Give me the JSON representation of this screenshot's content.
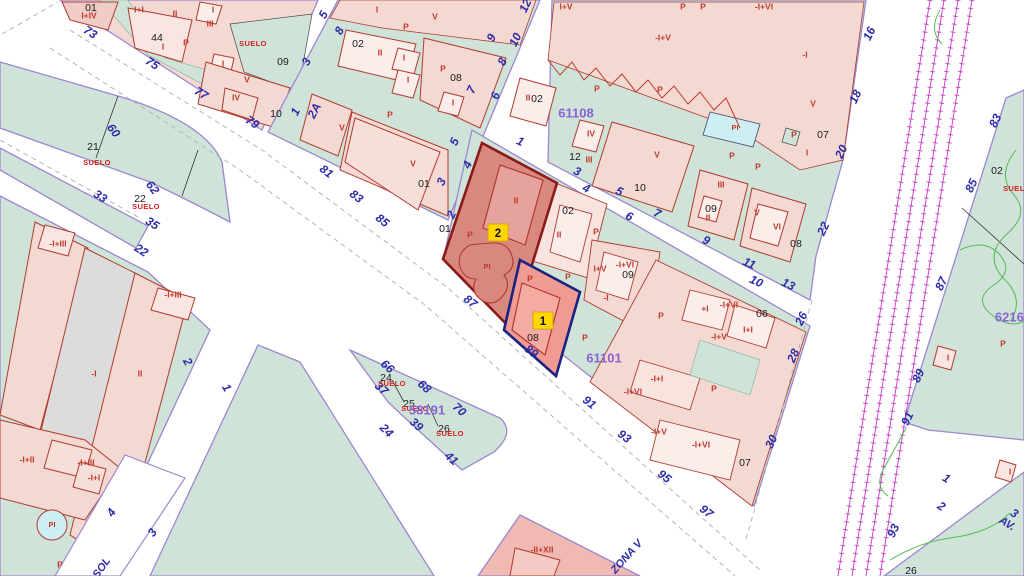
{
  "map": {
    "colors": {
      "street_number": "#2d2da8",
      "parcel_number": "#1a1a1a",
      "floor_label": "#c0392b",
      "suelo_label": "#d42020",
      "block_number": "#8a63d2",
      "badge_fill": "#ffd700",
      "selected_parcel_fill": "#d98880",
      "selected_border_red": "#8b1a1a",
      "selected_border_navy": "#1a237e",
      "green_block": "#cfe3d9",
      "pink_block": "#f4d9d3",
      "pool_fill": "#cdeef2",
      "railway": "#c837c8",
      "boundary_purple": "#9b87d0",
      "contour_green": "#55bb55"
    },
    "suelo_word": "SUELO",
    "selection_badges": [
      {
        "t": "2",
        "x": 498,
        "y": 233
      },
      {
        "t": "1",
        "x": 543,
        "y": 321
      }
    ],
    "block_numbers": [
      {
        "t": "61108",
        "x": 576,
        "y": 114
      },
      {
        "t": "61101",
        "x": 604,
        "y": 359
      },
      {
        "t": "58191",
        "x": 427,
        "y": 411
      },
      {
        "t": "62160",
        "x": 1013,
        "y": 318
      }
    ],
    "street_names": [
      {
        "t": "SOL",
        "x": 102,
        "y": 568,
        "r": -55
      },
      {
        "t": "ZONA V",
        "x": 627,
        "y": 557,
        "r": -48,
        "c": "#4a4a4a"
      },
      {
        "t": "AV.",
        "x": 1007,
        "y": 524,
        "r": 32
      }
    ],
    "street_numbers": [
      {
        "t": "73",
        "x": 90,
        "y": 33,
        "r": 33
      },
      {
        "t": "75",
        "x": 152,
        "y": 64,
        "r": 33
      },
      {
        "t": "77",
        "x": 201,
        "y": 94,
        "r": 33
      },
      {
        "t": "79",
        "x": 252,
        "y": 123,
        "r": 33
      },
      {
        "t": "81",
        "x": 326,
        "y": 172,
        "r": 38
      },
      {
        "t": "83",
        "x": 356,
        "y": 197,
        "r": 38
      },
      {
        "t": "85",
        "x": 382,
        "y": 221,
        "r": 38
      },
      {
        "t": "87",
        "x": 470,
        "y": 302,
        "r": 38
      },
      {
        "t": "89",
        "x": 531,
        "y": 352,
        "r": 38
      },
      {
        "t": "91",
        "x": 589,
        "y": 403,
        "r": 38
      },
      {
        "t": "93",
        "x": 624,
        "y": 437,
        "r": 38
      },
      {
        "t": "95",
        "x": 664,
        "y": 477,
        "r": 38
      },
      {
        "t": "97",
        "x": 706,
        "y": 512,
        "r": 38
      },
      {
        "t": "60",
        "x": 113,
        "y": 131,
        "r": 52
      },
      {
        "t": "62",
        "x": 152,
        "y": 188,
        "r": 52
      },
      {
        "t": "33",
        "x": 100,
        "y": 197,
        "r": 33
      },
      {
        "t": "35",
        "x": 152,
        "y": 224,
        "r": 33
      },
      {
        "t": "22",
        "x": 141,
        "y": 251,
        "r": 33
      },
      {
        "t": "2",
        "x": 187,
        "y": 362,
        "r": 60
      },
      {
        "t": "1",
        "x": 226,
        "y": 388,
        "r": 60
      },
      {
        "t": "24",
        "x": 386,
        "y": 431,
        "r": 45
      },
      {
        "t": "66",
        "x": 387,
        "y": 367,
        "r": 42
      },
      {
        "t": "68",
        "x": 424,
        "y": 387,
        "r": 42
      },
      {
        "t": "70",
        "x": 459,
        "y": 410,
        "r": 42
      },
      {
        "t": "37",
        "x": 381,
        "y": 389,
        "r": 42
      },
      {
        "t": "39",
        "x": 416,
        "y": 425,
        "r": 42
      },
      {
        "t": "41",
        "x": 451,
        "y": 459,
        "r": 42
      },
      {
        "t": "4",
        "x": 112,
        "y": 513,
        "r": -55
      },
      {
        "t": "3",
        "x": 153,
        "y": 533,
        "r": -55
      },
      {
        "t": "5",
        "x": 324,
        "y": 15,
        "r": -62
      },
      {
        "t": "8",
        "x": 340,
        "y": 31,
        "r": -62
      },
      {
        "t": "3",
        "x": 307,
        "y": 62,
        "r": -62
      },
      {
        "t": "2A",
        "x": 315,
        "y": 111,
        "r": -62
      },
      {
        "t": "1",
        "x": 296,
        "y": 112,
        "r": -62
      },
      {
        "t": "12",
        "x": 526,
        "y": 6,
        "r": -65
      },
      {
        "t": "10",
        "x": 516,
        "y": 40,
        "r": -65
      },
      {
        "t": "9",
        "x": 492,
        "y": 38,
        "r": -65
      },
      {
        "t": "8",
        "x": 503,
        "y": 62,
        "r": -65
      },
      {
        "t": "7",
        "x": 472,
        "y": 90,
        "r": -65
      },
      {
        "t": "6",
        "x": 496,
        "y": 96,
        "r": -65
      },
      {
        "t": "5",
        "x": 455,
        "y": 142,
        "r": -65
      },
      {
        "t": "4",
        "x": 468,
        "y": 165,
        "r": -65
      },
      {
        "t": "3",
        "x": 442,
        "y": 182,
        "r": -65
      },
      {
        "t": "2",
        "x": 452,
        "y": 215,
        "r": -65
      },
      {
        "t": "1",
        "x": 520,
        "y": 142,
        "r": 25
      },
      {
        "t": "3",
        "x": 577,
        "y": 172,
        "r": 25
      },
      {
        "t": "4",
        "x": 586,
        "y": 189,
        "r": 25
      },
      {
        "t": "5",
        "x": 619,
        "y": 192,
        "r": 25
      },
      {
        "t": "6",
        "x": 629,
        "y": 217,
        "r": 25
      },
      {
        "t": "7",
        "x": 657,
        "y": 214,
        "r": 25
      },
      {
        "t": "9",
        "x": 706,
        "y": 241,
        "r": 25
      },
      {
        "t": "11",
        "x": 749,
        "y": 264,
        "r": 25
      },
      {
        "t": "10",
        "x": 756,
        "y": 282,
        "r": 25
      },
      {
        "t": "13",
        "x": 788,
        "y": 285,
        "r": 25
      },
      {
        "t": "16",
        "x": 870,
        "y": 34,
        "r": -65
      },
      {
        "t": "18",
        "x": 856,
        "y": 97,
        "r": -65
      },
      {
        "t": "20",
        "x": 842,
        "y": 152,
        "r": -65
      },
      {
        "t": "22",
        "x": 824,
        "y": 229,
        "r": -65
      },
      {
        "t": "26",
        "x": 802,
        "y": 319,
        "r": -65
      },
      {
        "t": "28",
        "x": 794,
        "y": 356,
        "r": -65
      },
      {
        "t": "30",
        "x": 772,
        "y": 442,
        "r": -65
      },
      {
        "t": "83",
        "x": 996,
        "y": 121,
        "r": -65
      },
      {
        "t": "85",
        "x": 972,
        "y": 186,
        "r": -65
      },
      {
        "t": "87",
        "x": 942,
        "y": 284,
        "r": -65
      },
      {
        "t": "89",
        "x": 919,
        "y": 376,
        "r": -65
      },
      {
        "t": "91",
        "x": 908,
        "y": 419,
        "r": -65
      },
      {
        "t": "93",
        "x": 894,
        "y": 531,
        "r": -65
      },
      {
        "t": "1",
        "x": 946,
        "y": 479,
        "r": 32
      },
      {
        "t": "2",
        "x": 941,
        "y": 507,
        "r": 32
      },
      {
        "t": "3",
        "x": 1014,
        "y": 514,
        "r": 32
      }
    ],
    "parcel_numbers": [
      {
        "t": "01",
        "x": 91,
        "y": 8
      },
      {
        "t": "44",
        "x": 157,
        "y": 38
      },
      {
        "t": "09",
        "x": 283,
        "y": 62
      },
      {
        "t": "10",
        "x": 276,
        "y": 114
      },
      {
        "t": "02",
        "x": 358,
        "y": 44
      },
      {
        "t": "08",
        "x": 456,
        "y": 78
      },
      {
        "t": "01",
        "x": 424,
        "y": 184
      },
      {
        "t": "02",
        "x": 537,
        "y": 99
      },
      {
        "t": "12",
        "x": 575,
        "y": 157
      },
      {
        "t": "10",
        "x": 640,
        "y": 188
      },
      {
        "t": "07",
        "x": 823,
        "y": 135
      },
      {
        "t": "02",
        "x": 568,
        "y": 211
      },
      {
        "t": "01",
        "x": 445,
        "y": 229
      },
      {
        "t": "08",
        "x": 533,
        "y": 338
      },
      {
        "t": "09",
        "x": 628,
        "y": 275
      },
      {
        "t": "09",
        "x": 711,
        "y": 209
      },
      {
        "t": "08",
        "x": 796,
        "y": 244
      },
      {
        "t": "06",
        "x": 762,
        "y": 314
      },
      {
        "t": "07",
        "x": 745,
        "y": 463
      },
      {
        "t": "21",
        "x": 93,
        "y": 147
      },
      {
        "t": "22",
        "x": 140,
        "y": 199
      },
      {
        "t": "24",
        "x": 386,
        "y": 378
      },
      {
        "t": "25",
        "x": 409,
        "y": 404
      },
      {
        "t": "26",
        "x": 444,
        "y": 429
      },
      {
        "t": "02",
        "x": 997,
        "y": 171
      },
      {
        "t": "26",
        "x": 911,
        "y": 571
      }
    ],
    "suelo_labels": [
      {
        "x": 253,
        "y": 44
      },
      {
        "x": 97,
        "y": 163
      },
      {
        "x": 146,
        "y": 207
      },
      {
        "x": 392,
        "y": 384
      },
      {
        "x": 415,
        "y": 409
      },
      {
        "x": 450,
        "y": 434
      },
      {
        "x": 1017,
        "y": 189
      }
    ],
    "floor_labels": [
      {
        "t": "I+IV",
        "x": 89,
        "y": 16
      },
      {
        "t": "I+I",
        "x": 139,
        "y": 10
      },
      {
        "t": "II",
        "x": 175,
        "y": 14
      },
      {
        "t": "I",
        "x": 163,
        "y": 47
      },
      {
        "t": "P",
        "x": 186,
        "y": 43
      },
      {
        "t": "I",
        "x": 213,
        "y": 10
      },
      {
        "t": "III",
        "x": 210,
        "y": 24
      },
      {
        "t": "I",
        "x": 223,
        "y": 64
      },
      {
        "t": "V",
        "x": 247,
        "y": 80
      },
      {
        "t": "IV",
        "x": 236,
        "y": 98
      },
      {
        "t": "I",
        "x": 377,
        "y": 10
      },
      {
        "t": "V",
        "x": 435,
        "y": 17
      },
      {
        "t": "P",
        "x": 406,
        "y": 27
      },
      {
        "t": "II",
        "x": 380,
        "y": 53
      },
      {
        "t": "I",
        "x": 404,
        "y": 58
      },
      {
        "t": "I",
        "x": 408,
        "y": 80
      },
      {
        "t": "P",
        "x": 443,
        "y": 69
      },
      {
        "t": "I",
        "x": 453,
        "y": 103
      },
      {
        "t": "P",
        "x": 390,
        "y": 115
      },
      {
        "t": "V",
        "x": 342,
        "y": 128
      },
      {
        "t": "V",
        "x": 413,
        "y": 164
      },
      {
        "t": "II",
        "x": 528,
        "y": 98
      },
      {
        "t": "I+V",
        "x": 566,
        "y": 7
      },
      {
        "t": "P",
        "x": 683,
        "y": 7
      },
      {
        "t": "P",
        "x": 703,
        "y": 7
      },
      {
        "t": "-I+VI",
        "x": 764,
        "y": 7
      },
      {
        "t": "-I+V",
        "x": 663,
        "y": 38
      },
      {
        "t": "-I",
        "x": 805,
        "y": 55
      },
      {
        "t": "V",
        "x": 813,
        "y": 104
      },
      {
        "t": "I",
        "x": 807,
        "y": 153
      },
      {
        "t": "P",
        "x": 794,
        "y": 135
      },
      {
        "t": "P",
        "x": 597,
        "y": 89
      },
      {
        "t": "P",
        "x": 660,
        "y": 90
      },
      {
        "t": "IV",
        "x": 591,
        "y": 134
      },
      {
        "t": "III",
        "x": 589,
        "y": 160
      },
      {
        "t": "V",
        "x": 657,
        "y": 155
      },
      {
        "t": "III",
        "x": 721,
        "y": 185
      },
      {
        "t": "II",
        "x": 708,
        "y": 218
      },
      {
        "t": "V",
        "x": 757,
        "y": 213
      },
      {
        "t": "VI",
        "x": 777,
        "y": 227
      },
      {
        "t": "P",
        "x": 732,
        "y": 156
      },
      {
        "t": "P",
        "x": 758,
        "y": 167
      },
      {
        "t": "P",
        "x": 470,
        "y": 235
      },
      {
        "t": "II",
        "x": 516,
        "y": 201
      },
      {
        "t": "P",
        "x": 530,
        "y": 279
      },
      {
        "t": "II",
        "x": 559,
        "y": 235
      },
      {
        "t": "P",
        "x": 596,
        "y": 232
      },
      {
        "t": "P",
        "x": 568,
        "y": 277
      },
      {
        "t": "I+V",
        "x": 600,
        "y": 269
      },
      {
        "t": "-I+VI",
        "x": 625,
        "y": 265
      },
      {
        "t": "-I",
        "x": 606,
        "y": 298
      },
      {
        "t": "P",
        "x": 585,
        "y": 338
      },
      {
        "t": "+I",
        "x": 705,
        "y": 309
      },
      {
        "t": "-I+VI",
        "x": 729,
        "y": 305
      },
      {
        "t": "I+I",
        "x": 748,
        "y": 330
      },
      {
        "t": "-I+V",
        "x": 719,
        "y": 337
      },
      {
        "t": "-I+I",
        "x": 657,
        "y": 379
      },
      {
        "t": "-I+VI",
        "x": 633,
        "y": 392
      },
      {
        "t": "P",
        "x": 714,
        "y": 389
      },
      {
        "t": "-I+V",
        "x": 659,
        "y": 432
      },
      {
        "t": "-I+VI",
        "x": 701,
        "y": 445
      },
      {
        "t": "P",
        "x": 661,
        "y": 316
      },
      {
        "t": "-I+III",
        "x": 58,
        "y": 244
      },
      {
        "t": "-I+III",
        "x": 173,
        "y": 295
      },
      {
        "t": "-I",
        "x": 94,
        "y": 374
      },
      {
        "t": "II",
        "x": 140,
        "y": 374
      },
      {
        "t": "-I+II",
        "x": 27,
        "y": 460
      },
      {
        "t": "-I+III",
        "x": 86,
        "y": 463
      },
      {
        "t": "-I+I",
        "x": 94,
        "y": 478
      },
      {
        "t": "P",
        "x": 60,
        "y": 565
      },
      {
        "t": "-II+XII",
        "x": 542,
        "y": 550
      },
      {
        "t": "P",
        "x": 1003,
        "y": 344
      },
      {
        "t": "I",
        "x": 948,
        "y": 358
      },
      {
        "t": "I",
        "x": 1010,
        "y": 472
      }
    ],
    "pool_labels": [
      {
        "t": "PI",
        "x": 735,
        "y": 128
      },
      {
        "t": "PI",
        "x": 487,
        "y": 267
      },
      {
        "t": "PI",
        "x": 52,
        "y": 525
      }
    ]
  }
}
